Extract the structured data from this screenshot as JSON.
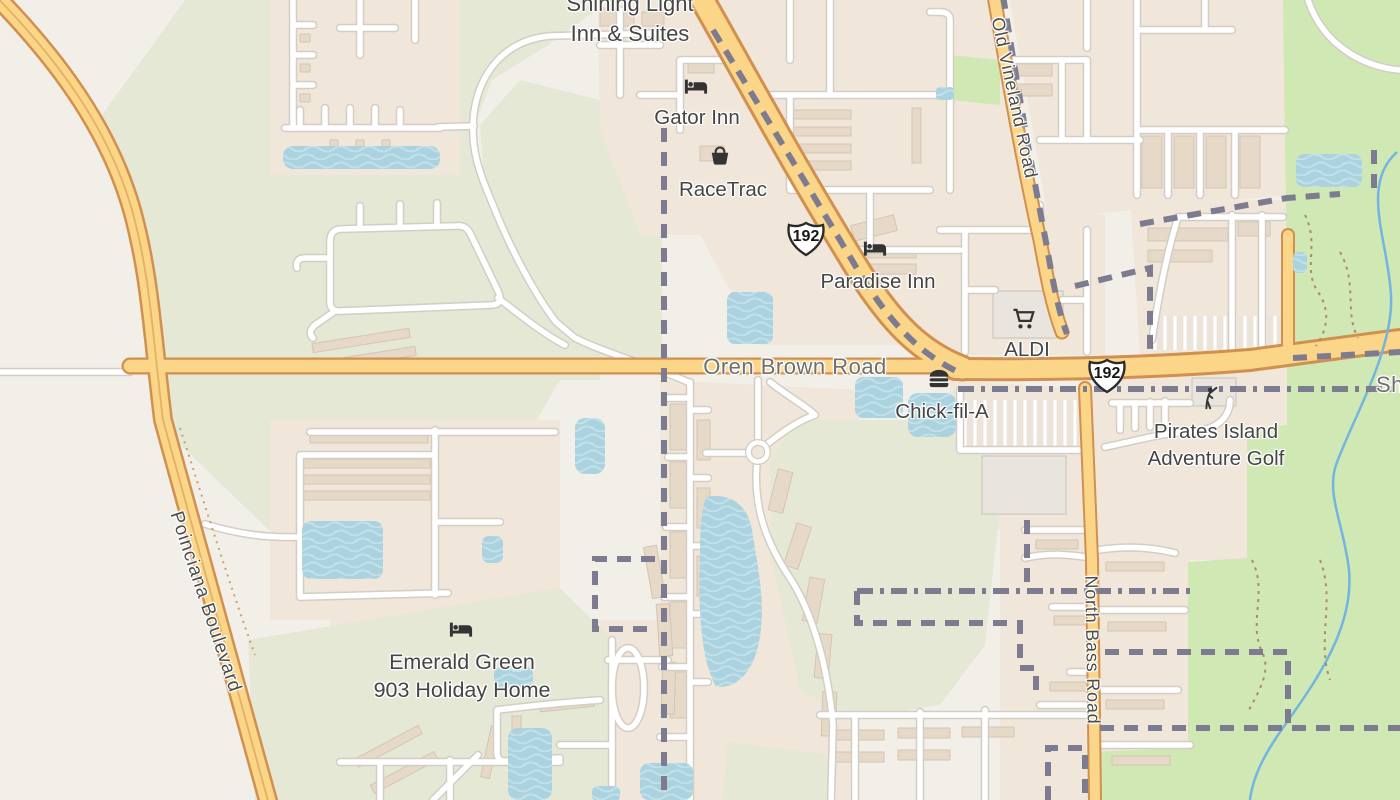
{
  "map": {
    "shield": {
      "us_192": "192"
    },
    "road_labels": {
      "oren_brown": "Oren Brown Road",
      "poinciana": "Poinciana Boulevard",
      "old_vineland": "Old Vineland Road",
      "north_bass": "North Bass Road",
      "edge_partial": "Sh"
    },
    "pois": {
      "shining_light": {
        "line1": "Shining Light",
        "line2": "Inn & Suites",
        "icon": "lodging-icon"
      },
      "gator_inn": {
        "name": "Gator Inn",
        "icon": "lodging-icon"
      },
      "racetrac": {
        "name": "RaceTrac",
        "icon": "shop-basket-icon"
      },
      "paradise_inn": {
        "name": "Paradise Inn",
        "icon": "lodging-icon"
      },
      "aldi": {
        "name": "ALDI",
        "icon": "supermarket-cart-icon"
      },
      "chick_fil_a": {
        "name": "Chick-fil-A",
        "icon": "fast-food-icon"
      },
      "pirates_island": {
        "line1": "Pirates Island",
        "line2": "Adventure Golf",
        "icon": "golf-icon"
      },
      "emerald_green": {
        "line1": "Emerald Green",
        "line2": "903 Holiday Home",
        "icon": "lodging-icon"
      }
    },
    "colors": {
      "land": "#f2efe8",
      "residential": "#f0e6d9",
      "green_pale": "#e4e8d5",
      "grass": "#cfe8b4",
      "water": "#aad3df",
      "road_primary_fill": "#fbd688",
      "road_primary_casing": "#d1904f",
      "road_minor_casing": "#d2cec6",
      "boundary": "#7c7b90",
      "poi_label": "#454545"
    }
  }
}
